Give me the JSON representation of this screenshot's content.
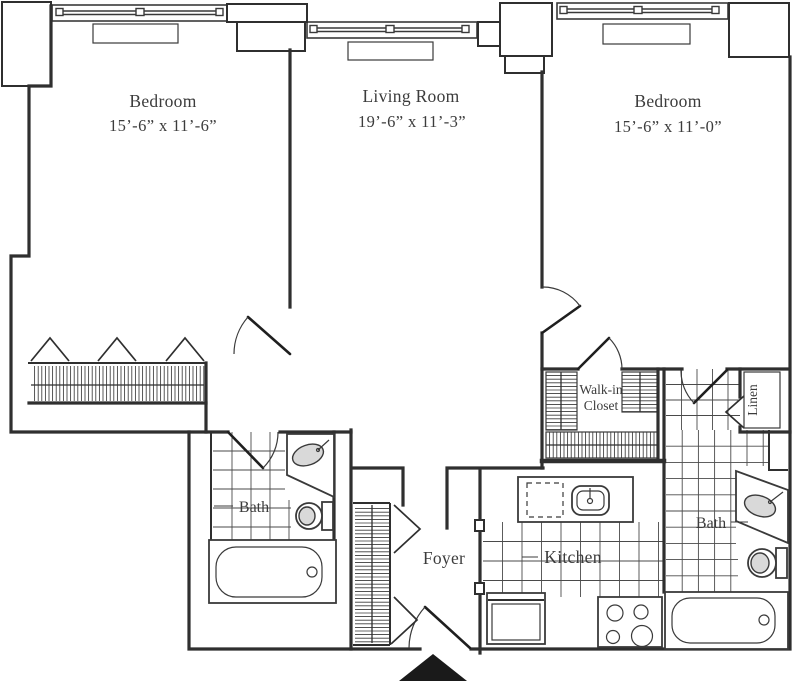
{
  "floorplan": {
    "rooms": {
      "bedroom_left": {
        "label": "Bedroom",
        "dims": "15’-6” x 11’-6”"
      },
      "living_room": {
        "label": "Living Room",
        "dims": "19’-6” x 11’-3”"
      },
      "bedroom_right": {
        "label": "Bedroom",
        "dims": "15’-6” x 11’-0”"
      },
      "walk_in_closet": {
        "label_line1": "Walk-in",
        "label_line2": "Closet"
      },
      "linen_closet": {
        "label": "Linen"
      },
      "bath_left": {
        "label": "Bath"
      },
      "bath_right": {
        "label": "Bath"
      },
      "kitchen": {
        "label": "Kitchen"
      },
      "foyer": {
        "label": "Foyer"
      }
    },
    "colors": {
      "wall": "#2f2f2f",
      "text": "#3c3c3c",
      "fixture_fill": "#d9d9d9",
      "entry_marker": "#1a1a1a",
      "background": "#ffffff"
    }
  }
}
